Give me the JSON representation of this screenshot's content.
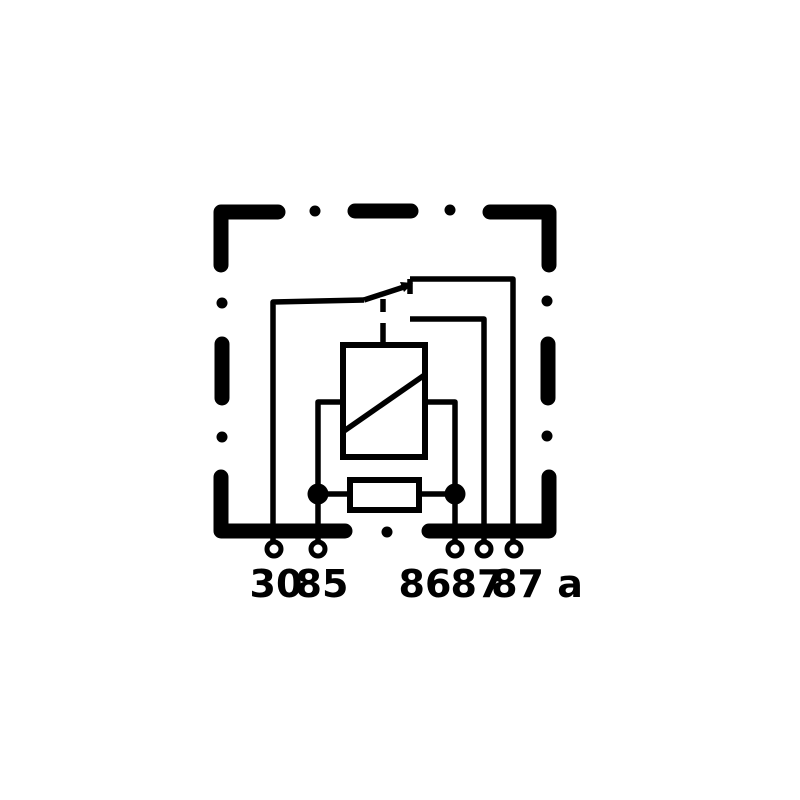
{
  "diagram": {
    "type": "automotive-relay-wiring-schematic",
    "colors": {
      "line": "#000000",
      "background": "#ffffff"
    },
    "terminals": [
      {
        "label": "30"
      },
      {
        "label": "85"
      },
      {
        "label": "86"
      },
      {
        "label": "87"
      },
      {
        "label": "87 a"
      }
    ],
    "components": [
      "relay-housing-dashed-outline",
      "changeover-switch-contact",
      "relay-coil",
      "parallel-resistor"
    ]
  }
}
